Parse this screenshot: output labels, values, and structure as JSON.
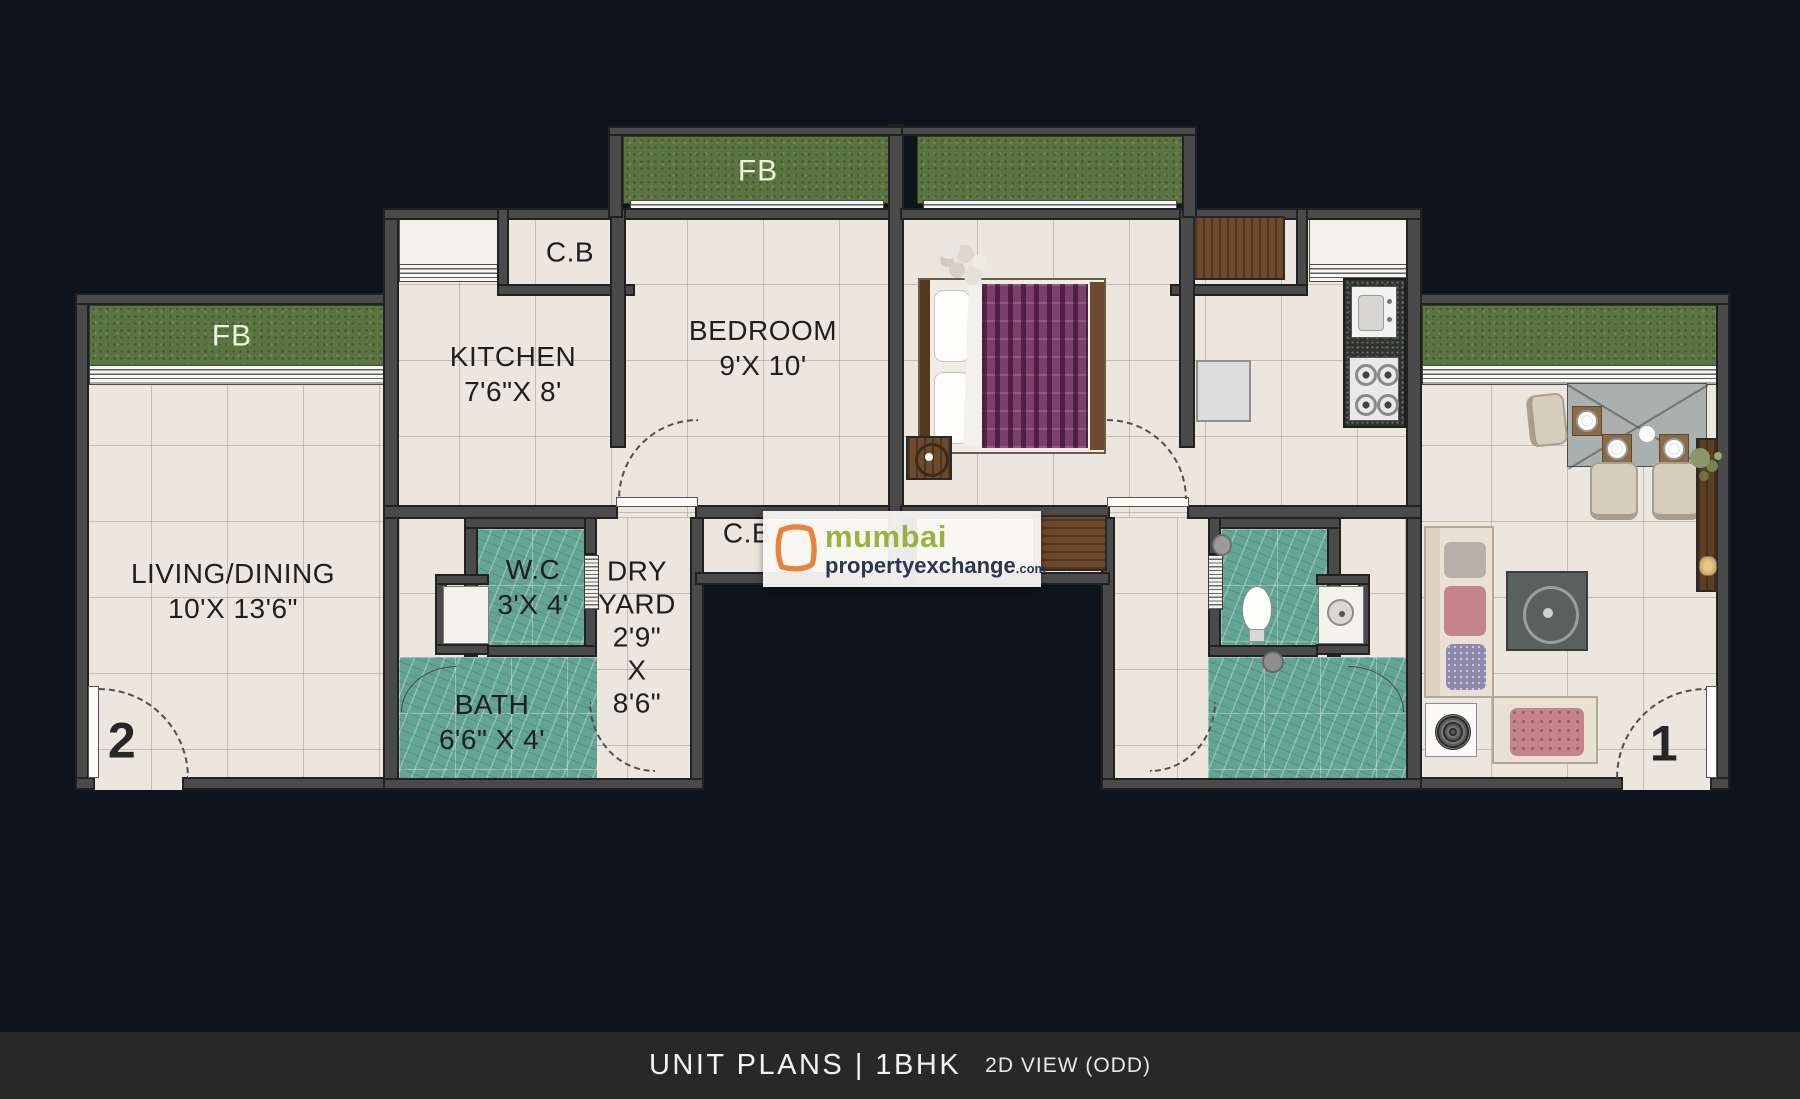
{
  "title_bar": {
    "main": "UNIT  PLANS | 1BHK",
    "sub": "2D VIEW (ODD)"
  },
  "watermark": {
    "line1": "mumbai",
    "line2": "propertyexchange",
    "tld": ".com",
    "icon": "orange-open-square-icon"
  },
  "units": {
    "left_number": "2",
    "right_number": "1"
  },
  "rooms": {
    "fb_left": "FB",
    "fb_top": "FB",
    "cb_top": "C.B",
    "cb_passage": "C.B",
    "kitchen": "KITCHEN\n7'6\"X 8'",
    "bedroom": "BEDROOM\n9'X 10'",
    "living": "LIVING/DINING\n10'X 13'6\"",
    "wc": "W.C\n3'X 4'",
    "dry_yard": "DRY\nYARD\n2'9\"\nX\n8'6\"",
    "bath": "BATH\n6'6\" X 4'"
  },
  "colors": {
    "background": "#0e141b",
    "floor": "#ebe6de",
    "wall": "#4a4a4a",
    "flower_bed_green": "#5c7342",
    "bathroom_teal": "#64a492",
    "wood_brown": "#6d4a2c",
    "title_bar_bg": "#282828",
    "logo_orange": "#e8823c",
    "logo_green": "#96b43d",
    "logo_navy": "#2b3750"
  }
}
